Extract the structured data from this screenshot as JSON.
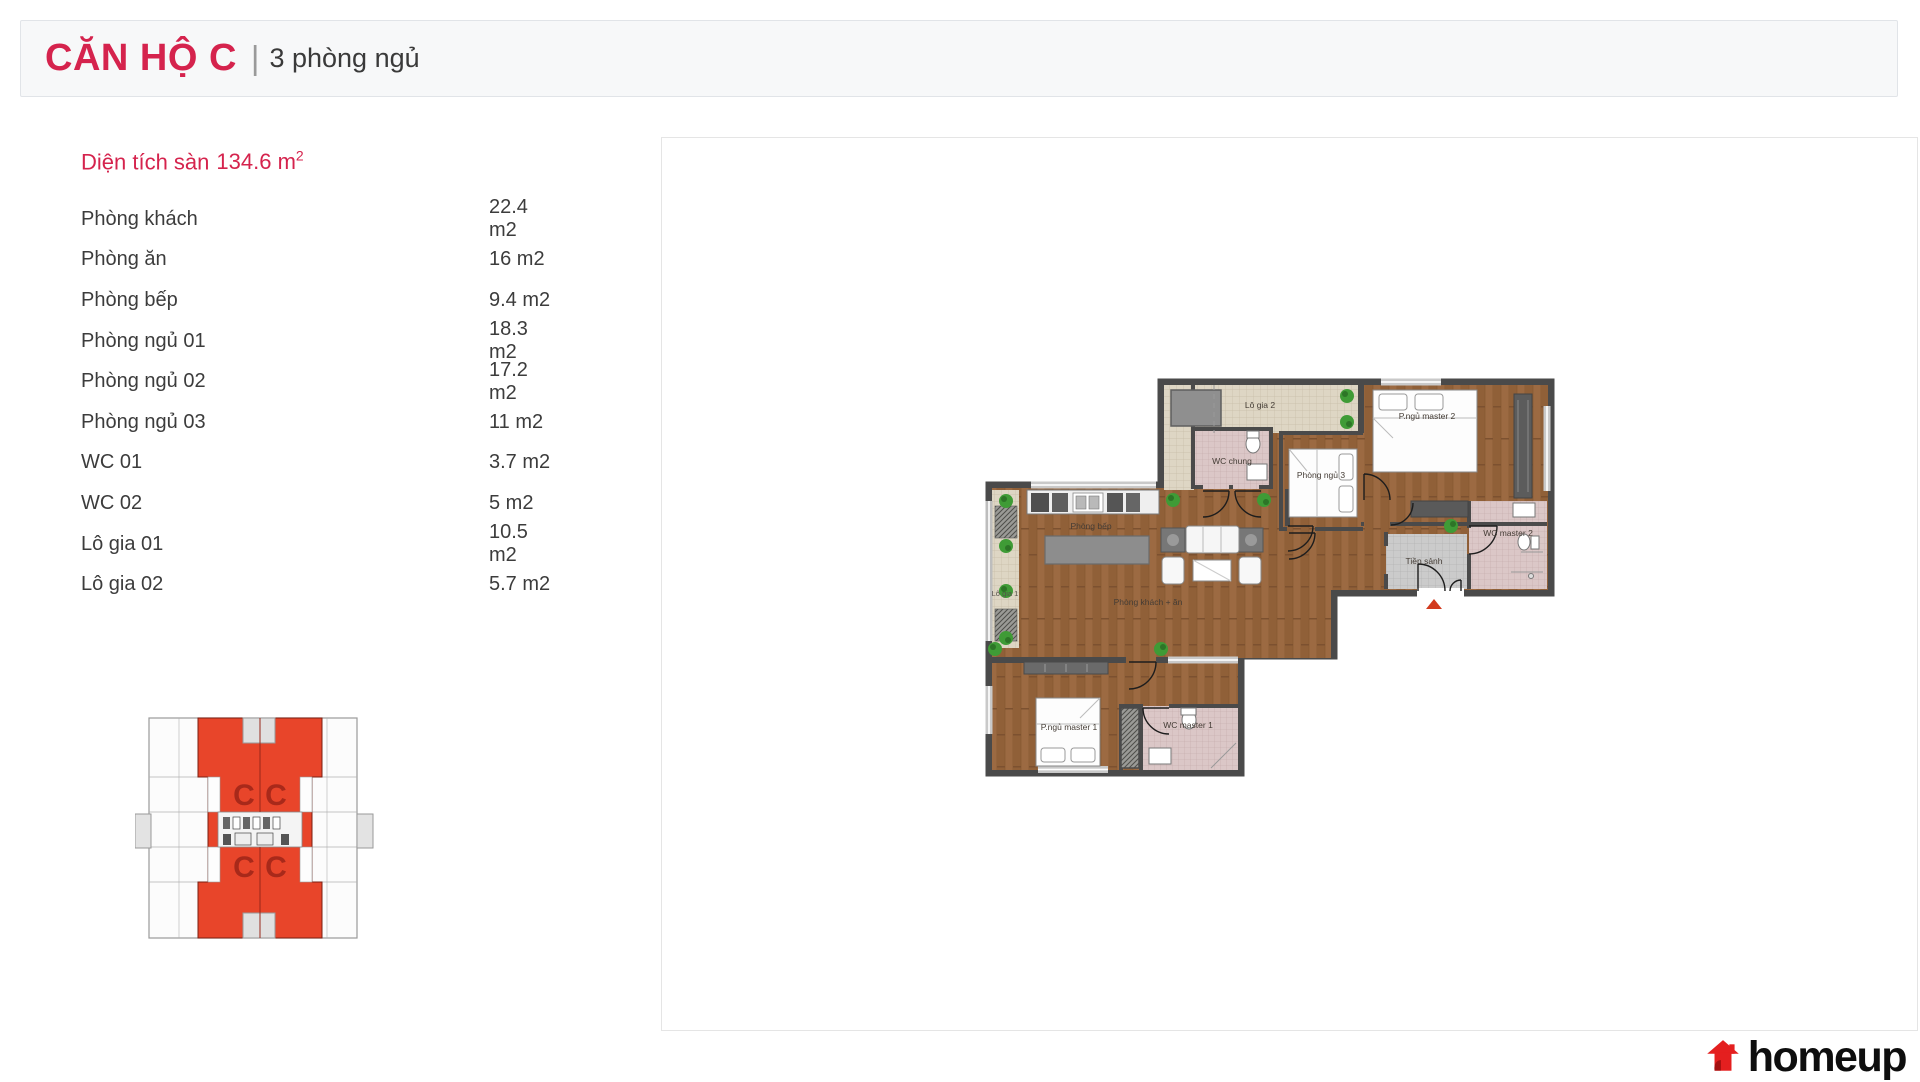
{
  "header": {
    "title": "CĂN HỘ C",
    "separator": "|",
    "subtitle": "3 phòng ngủ"
  },
  "area": {
    "prefix": "Diện tích sàn",
    "value": "134.6",
    "unit": "m",
    "sup": "2"
  },
  "rooms": [
    {
      "label": "Phòng khách",
      "area": "22.4 m2"
    },
    {
      "label": "Phòng ăn",
      "area": "16 m2"
    },
    {
      "label": "Phòng bếp",
      "area": "9.4 m2"
    },
    {
      "label": "Phòng ngủ 01",
      "area": "18.3 m2"
    },
    {
      "label": "Phòng ngủ 02",
      "area": "17.2 m2"
    },
    {
      "label": "Phòng ngủ 03",
      "area": "11 m2"
    },
    {
      "label": "WC 01",
      "area": "3.7 m2"
    },
    {
      "label": "WC 02",
      "area": "5 m2"
    },
    {
      "label": "Lô gia 01",
      "area": "10.5 m2"
    },
    {
      "label": "Lô gia 02",
      "area": "5.7 m2"
    }
  ],
  "floorplan": {
    "rooms": {
      "lo_gia_2": "Lô gia 2",
      "wc_chung": "WC chung",
      "p_ngu_master_2": "P.ngủ master 2",
      "phong_ngu_3": "Phòng ngủ 3",
      "wc_master_2": "WC master 2",
      "tien_sanh": "Tiền sảnh",
      "phong_bep": "Phòng bếp",
      "lo_gia_1": "Lô gia 1",
      "phong_khach_an": "Phòng khách + ăn",
      "p_ngu_master_1": "P.ngủ master 1",
      "wc_master_1": "WC master 1"
    }
  },
  "keyplan": {
    "units": [
      "C",
      "C",
      "C",
      "C"
    ]
  },
  "logo": {
    "text": "homeup"
  },
  "colors": {
    "accent": "#d5234d",
    "keyplan_red": "#e8452a",
    "keyplan_letter": "#a8291a",
    "logo_red": "#e41f1f",
    "wall": "#4a4a4a",
    "wood": "#9c6a42"
  }
}
